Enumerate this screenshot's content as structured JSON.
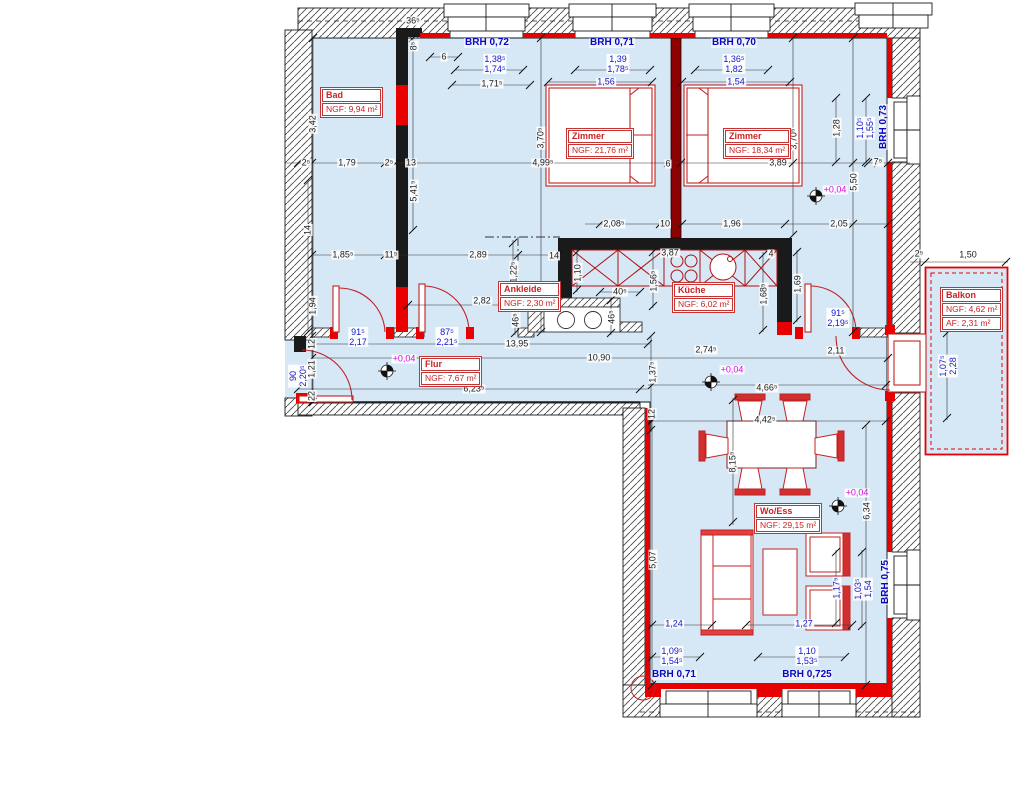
{
  "drawing": {
    "type": "floor-plan",
    "language": "de",
    "colors": {
      "floor": "#d6e7f6",
      "new_wall_red": "#e80000",
      "furniture_red": "#c32222",
      "dim_black": "#1c1c1c",
      "dim_blue": "#1616c8",
      "brh_blue": "#0909c2",
      "elevation_magenta": "#e008e0",
      "party_wall": "#8b0000"
    }
  },
  "rooms": [
    {
      "name": "Bad",
      "rows": [
        "NGF: 9,94 m²"
      ],
      "x": 320,
      "y": 87
    },
    {
      "name": "Zimmer",
      "rows": [
        "NGF: 21,76 m²"
      ],
      "x": 566,
      "y": 128
    },
    {
      "name": "Zimmer",
      "rows": [
        "NGF: 18,34 m²"
      ],
      "x": 723,
      "y": 128
    },
    {
      "name": "Ankleide",
      "rows": [
        "NGF: 2,30 m²"
      ],
      "x": 498,
      "y": 281
    },
    {
      "name": "Küche",
      "rows": [
        "NGF: 6,02 m²"
      ],
      "x": 672,
      "y": 282
    },
    {
      "name": "Flur",
      "rows": [
        "NGF: 7,67 m²"
      ],
      "x": 419,
      "y": 356
    },
    {
      "name": "Wo/Ess",
      "rows": [
        "NGF: 29,15 m²"
      ],
      "x": 754,
      "y": 503
    },
    {
      "name": "Balkon",
      "rows": [
        "NGF: 4,62 m²",
        "AF: 2,31 m²"
      ],
      "x": 940,
      "y": 287
    }
  ],
  "labels": {
    "brh": [
      {
        "text": "BRH 0,72",
        "x": 487,
        "y": 43,
        "rot": 0
      },
      {
        "text": "BRH 0,71",
        "x": 612,
        "y": 43,
        "rot": 0
      },
      {
        "text": "BRH 0,70",
        "x": 734,
        "y": 43,
        "rot": 0
      },
      {
        "text": "BRH 0,73",
        "x": 884,
        "y": 127,
        "rot": -90
      },
      {
        "text": "BRH 0,75",
        "x": 886,
        "y": 582,
        "rot": -90
      },
      {
        "text": "BRH 0,71",
        "x": 674,
        "y": 675,
        "rot": 0
      },
      {
        "text": "BRH 0,725",
        "x": 807,
        "y": 675,
        "rot": 0
      }
    ],
    "pairs_blue": [
      {
        "l1": "1,38⁵",
        "l2": "1,74⁵",
        "x": 495,
        "y": 64,
        "rot": 0
      },
      {
        "l1": "1,39",
        "l2": "1,78⁵",
        "x": 618,
        "y": 64,
        "rot": 0
      },
      {
        "l1": "1,36⁵",
        "l2": "1,82",
        "x": 734,
        "y": 64,
        "rot": 0
      },
      {
        "l1": "1,10⁵",
        "l2": "1,55⁵",
        "x": 865,
        "y": 128,
        "rot": -90
      },
      {
        "l1": "91⁵",
        "l2": "2,17",
        "x": 358,
        "y": 337,
        "rot": 0
      },
      {
        "l1": "87⁵",
        "l2": "2,21⁵",
        "x": 447,
        "y": 337,
        "rot": 0
      },
      {
        "l1": "91⁵",
        "l2": "2,19⁵",
        "x": 838,
        "y": 318,
        "rot": 0
      },
      {
        "l1": "90",
        "l2": "2,20⁵",
        "x": 298,
        "y": 376,
        "rot": -90
      },
      {
        "l1": "1,07⁵",
        "l2": "2,28",
        "x": 948,
        "y": 366,
        "rot": -90
      },
      {
        "l1": "1,09⁵",
        "l2": "1,54⁵",
        "x": 672,
        "y": 656,
        "rot": 0
      },
      {
        "l1": "1,10",
        "l2": "1,53⁵",
        "x": 807,
        "y": 656,
        "rot": 0
      },
      {
        "l1": "1,03⁵",
        "l2": "1,54",
        "x": 863,
        "y": 589,
        "rot": -90
      }
    ],
    "dims_blue": [
      {
        "text": "1,56",
        "x": 606,
        "y": 82,
        "rot": 0
      },
      {
        "text": "1,54",
        "x": 736,
        "y": 82,
        "rot": 0
      },
      {
        "text": "1,24",
        "x": 674,
        "y": 624,
        "rot": 0
      },
      {
        "text": "1,27",
        "x": 804,
        "y": 624,
        "rot": 0
      },
      {
        "text": "1,17⁵",
        "x": 837,
        "y": 588,
        "rot": -90
      }
    ],
    "dims_black": [
      {
        "text": "36⁵",
        "x": 413,
        "y": 21,
        "rot": 0
      },
      {
        "text": "8⁵",
        "x": 414,
        "y": 46,
        "rot": -90
      },
      {
        "text": "6",
        "x": 444,
        "y": 57,
        "rot": 0
      },
      {
        "text": "1,71⁵",
        "x": 492,
        "y": 84,
        "rot": 0
      },
      {
        "text": "3,42",
        "x": 313,
        "y": 124,
        "rot": -90
      },
      {
        "text": "2⁵",
        "x": 306,
        "y": 163,
        "rot": 0
      },
      {
        "text": "1,79",
        "x": 347,
        "y": 163,
        "rot": 0
      },
      {
        "text": "2⁵",
        "x": 389,
        "y": 163,
        "rot": 0
      },
      {
        "text": "13",
        "x": 411,
        "y": 163,
        "rot": 0
      },
      {
        "text": "5,41⁵",
        "x": 414,
        "y": 191,
        "rot": -90
      },
      {
        "text": "3,70⁵",
        "x": 541,
        "y": 138,
        "rot": -90
      },
      {
        "text": "4,99⁵",
        "x": 543,
        "y": 163,
        "rot": 0
      },
      {
        "text": "6",
        "x": 668,
        "y": 164,
        "rot": 0
      },
      {
        "text": "3,89",
        "x": 778,
        "y": 163,
        "rot": 0
      },
      {
        "text": "3,70⁵",
        "x": 794,
        "y": 139,
        "rot": -90
      },
      {
        "text": "1,28",
        "x": 837,
        "y": 128,
        "rot": -90
      },
      {
        "text": "5,50",
        "x": 854,
        "y": 182,
        "rot": -90
      },
      {
        "text": "7⁵",
        "x": 878,
        "y": 162,
        "rot": 0
      },
      {
        "text": "14",
        "x": 308,
        "y": 230,
        "rot": -90
      },
      {
        "text": "1,85⁵",
        "x": 343,
        "y": 255,
        "rot": 0
      },
      {
        "text": "11⁵",
        "x": 391,
        "y": 255,
        "rot": 0
      },
      {
        "text": "2,89",
        "x": 478,
        "y": 255,
        "rot": 0
      },
      {
        "text": "14",
        "x": 554,
        "y": 256,
        "rot": 0
      },
      {
        "text": "1,94",
        "x": 313,
        "y": 306,
        "rot": -90
      },
      {
        "text": "2,08⁵",
        "x": 614,
        "y": 224,
        "rot": 0
      },
      {
        "text": "10",
        "x": 665,
        "y": 224,
        "rot": 0
      },
      {
        "text": "1,96",
        "x": 732,
        "y": 224,
        "rot": 0
      },
      {
        "text": "2,05",
        "x": 839,
        "y": 224,
        "rot": 0
      },
      {
        "text": "1,22⁵",
        "x": 514,
        "y": 272,
        "rot": -90
      },
      {
        "text": "2,82",
        "x": 482,
        "y": 301,
        "rot": 0
      },
      {
        "text": "1,10",
        "x": 578,
        "y": 273,
        "rot": -90
      },
      {
        "text": "3,87",
        "x": 670,
        "y": 253,
        "rot": 0
      },
      {
        "text": "4",
        "x": 771,
        "y": 254,
        "rot": 0
      },
      {
        "text": "40⁵",
        "x": 620,
        "y": 292,
        "rot": 0
      },
      {
        "text": "46⁵",
        "x": 516,
        "y": 320,
        "rot": -90
      },
      {
        "text": "46⁵",
        "x": 612,
        "y": 317,
        "rot": -90
      },
      {
        "text": "1,56⁵",
        "x": 654,
        "y": 281,
        "rot": -90
      },
      {
        "text": "1,68⁵",
        "x": 764,
        "y": 294,
        "rot": -90
      },
      {
        "text": "1,69",
        "x": 798,
        "y": 284,
        "rot": -90
      },
      {
        "text": "13,95",
        "x": 517,
        "y": 344,
        "rot": 0
      },
      {
        "text": "10,90",
        "x": 599,
        "y": 358,
        "rot": 0
      },
      {
        "text": "2,74⁵",
        "x": 706,
        "y": 350,
        "rot": 0
      },
      {
        "text": "2,11",
        "x": 836,
        "y": 351,
        "rot": 0
      },
      {
        "text": "6,23⁵",
        "x": 474,
        "y": 389,
        "rot": 0
      },
      {
        "text": "4,66⁵",
        "x": 767,
        "y": 388,
        "rot": 0
      },
      {
        "text": "4,42⁵",
        "x": 765,
        "y": 420,
        "rot": 0
      },
      {
        "text": "1,37⁵",
        "x": 653,
        "y": 372,
        "rot": -90
      },
      {
        "text": "12",
        "x": 652,
        "y": 414,
        "rot": -90
      },
      {
        "text": "12",
        "x": 312,
        "y": 344,
        "rot": -90
      },
      {
        "text": "1,21",
        "x": 312,
        "y": 369,
        "rot": -90
      },
      {
        "text": "22",
        "x": 312,
        "y": 396,
        "rot": -90
      },
      {
        "text": "8,15⁵",
        "x": 733,
        "y": 462,
        "rot": -90
      },
      {
        "text": "6,34",
        "x": 867,
        "y": 511,
        "rot": -90
      },
      {
        "text": "5,07",
        "x": 653,
        "y": 560,
        "rot": -90
      },
      {
        "text": "2⁵",
        "x": 919,
        "y": 254,
        "rot": 0
      },
      {
        "text": "1,50",
        "x": 968,
        "y": 255,
        "rot": 0
      }
    ],
    "elevations": [
      {
        "text": "+0,04",
        "x": 835,
        "y": 190
      },
      {
        "text": "+0,04",
        "x": 404,
        "y": 359
      },
      {
        "text": "+0,04",
        "x": 732,
        "y": 370
      },
      {
        "text": "+0,04",
        "x": 857,
        "y": 493
      }
    ]
  }
}
